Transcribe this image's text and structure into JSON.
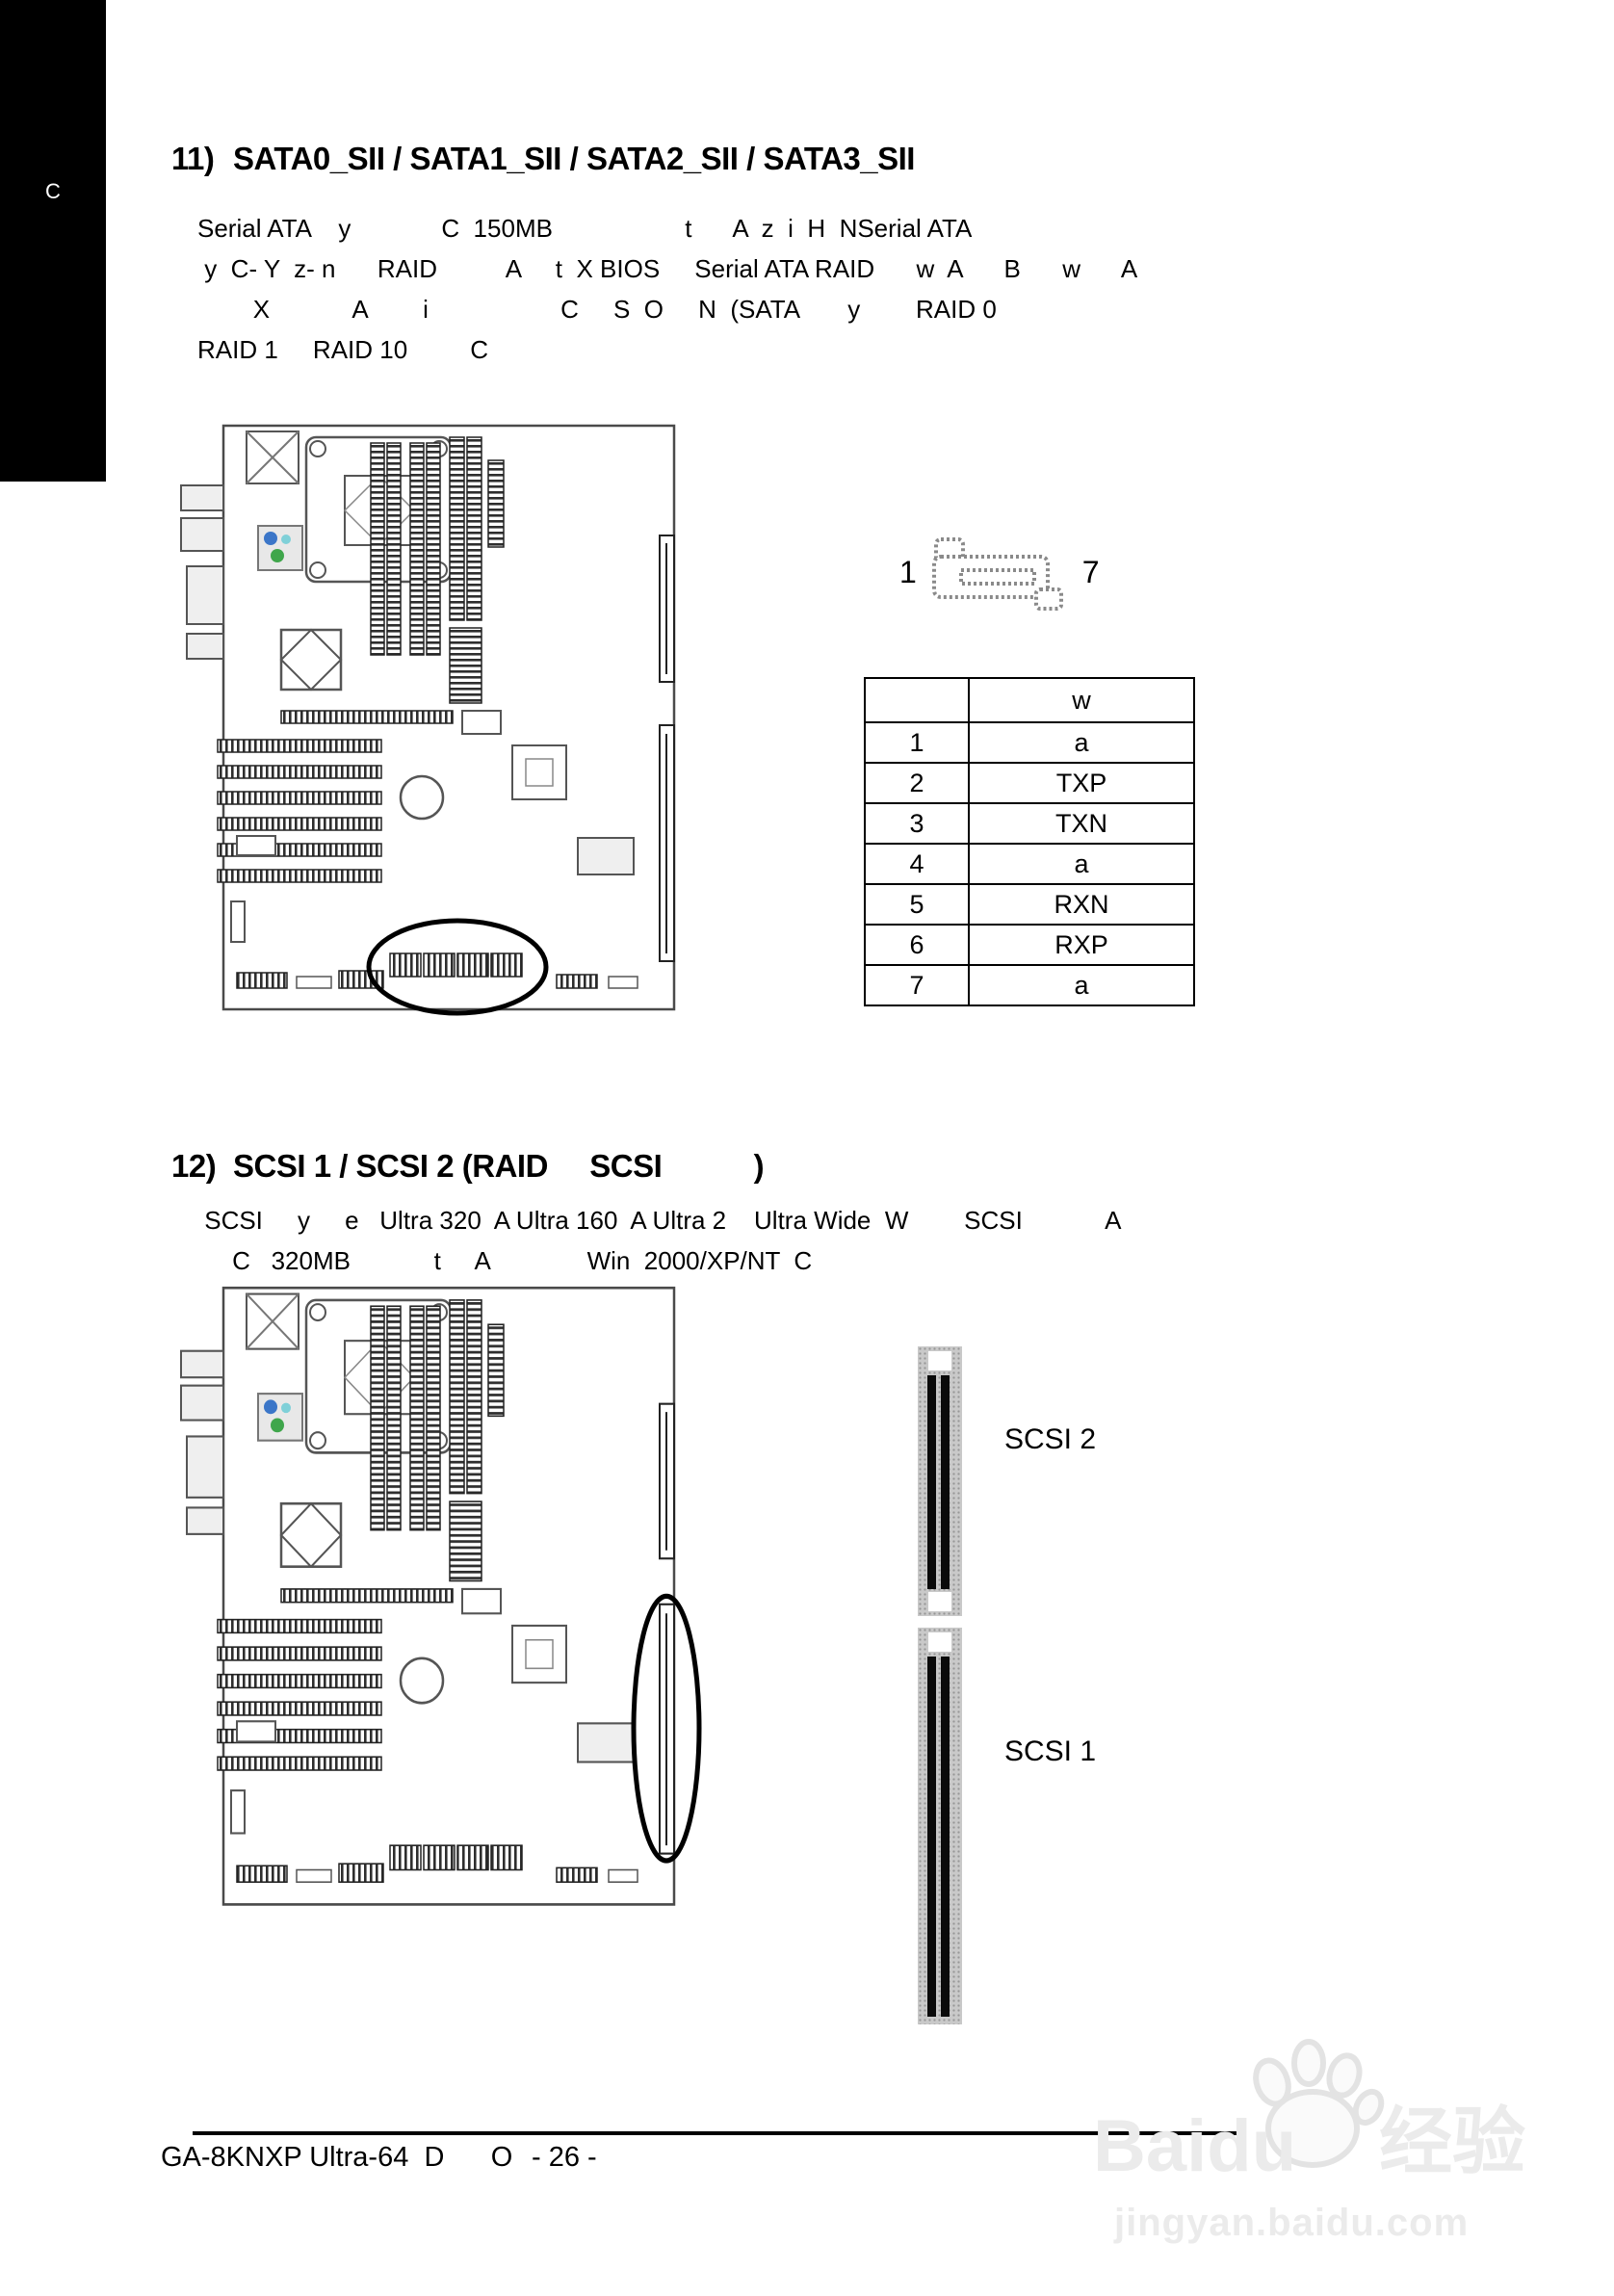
{
  "sidebar": {
    "label": "C"
  },
  "section11": {
    "number": "11)",
    "title": "SATA0_SII / SATA1_SII / SATA2_SII / SATA3_SII",
    "body_lines": [
      "Serial ATA    y             C  150MB                   t      A  z  i  H  NSerial ATA",
      " y  C- Y  z- n      RAID          A     t  X BIOS     Serial ATA RAID      w  A      B      w      A",
      "        X            A        i                   C     S  O     N  (SATA       y        RAID 0",
      "RAID 1     RAID 10         C"
    ],
    "connector": {
      "pin_start": "1",
      "pin_end": "7"
    },
    "pin_table": {
      "headers": [
        "",
        "w"
      ],
      "rows": [
        [
          "1",
          "a"
        ],
        [
          "2",
          "TXP"
        ],
        [
          "3",
          "TXN"
        ],
        [
          "4",
          "a"
        ],
        [
          "5",
          "RXN"
        ],
        [
          "6",
          "RXP"
        ],
        [
          "7",
          "a"
        ]
      ]
    }
  },
  "section12": {
    "number": "12)",
    "title": "SCSI 1 / SCSI 2 (RAID     SCSI           )",
    "body_lines": [
      " SCSI     y     e   Ultra 320  A Ultra 160  A Ultra 2    Ultra Wide  W        SCSI            A",
      "     C   320MB            t     A              Win  2000/XP/NT  C"
    ],
    "scsi2_label": "SCSI 2",
    "scsi1_label": "SCSI 1"
  },
  "footer": {
    "model": "GA-8KNXP Ultra-64  D      O",
    "page_number": "- 26 -"
  },
  "watermark": {
    "brand": "Baidu",
    "brand_suffix": "经验",
    "url": "jingyan.baidu.com"
  }
}
